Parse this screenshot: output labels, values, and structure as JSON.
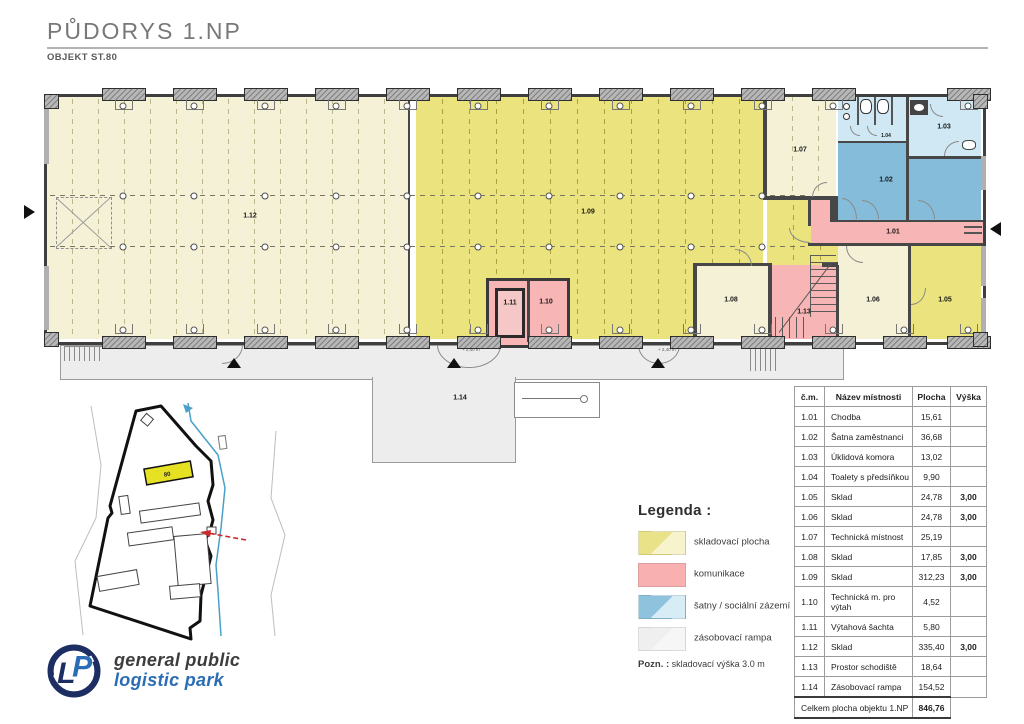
{
  "header": {
    "title": "PŮDORYS 1.NP",
    "subtitle": "OBJEKT ST.80"
  },
  "colors": {
    "storage_strong": "#ebe47e",
    "storage_pale": "#f4f1d6",
    "circulation": "#f8b5b5",
    "social": "#85bcd9",
    "social_light": "#cfe8f3",
    "ramp": "#ededed",
    "wall": "#474747",
    "site_highlight": "#e6e123",
    "stream": "#4aa0c8",
    "marker_red": "#cc2a2a",
    "logo_navy": "#1d2e63",
    "logo_blue": "#2a6db4"
  },
  "plan": {
    "labels": {
      "r101": "1.01",
      "r102": "1.02",
      "r103": "1.03",
      "r104": "1.04",
      "r105": "1.05",
      "r106": "1.06",
      "r107": "1.07",
      "r108": "1.08",
      "r109": "1.09",
      "r110": "1.10",
      "r111": "1.11",
      "r112": "1.12",
      "r113": "1.13",
      "r114": "1.14"
    },
    "dim_label": "+ 2,40 m"
  },
  "site_plan": {
    "building_label": "80"
  },
  "legend": {
    "title": "Legenda :",
    "items": [
      {
        "label": "skladovací plocha",
        "color_a": "#e9e288",
        "color_b": "#f6f3cd"
      },
      {
        "label": "komunikace",
        "color_a": "#f8b0b0",
        "color_b": "#f8b0b0"
      },
      {
        "label": "šatny / sociální zázemí",
        "color_a": "#8fc2dd",
        "color_b": "#d8ecf6"
      },
      {
        "label": "zásobovací rampa",
        "color_a": "#efefef",
        "color_b": "#f6f6f6"
      }
    ],
    "note_label": "Pozn. :",
    "note_text": "skladovací výška 3.0 m"
  },
  "room_table": {
    "headers": [
      "č.m.",
      "Název místnosti",
      "Plocha",
      "Výška"
    ],
    "rows": [
      [
        "1.01",
        "Chodba",
        "15,61",
        ""
      ],
      [
        "1.02",
        "Šatna zaměstnanci",
        "36,68",
        ""
      ],
      [
        "1.03",
        "Úklidová komora",
        "13,02",
        ""
      ],
      [
        "1.04",
        "Toalety s předsíňkou",
        "9,90",
        ""
      ],
      [
        "1.05",
        "Sklad",
        "24,78",
        "3,00"
      ],
      [
        "1.06",
        "Sklad",
        "24,78",
        "3,00"
      ],
      [
        "1.07",
        "Technická místnost",
        "25,19",
        ""
      ],
      [
        "1.08",
        "Sklad",
        "17,85",
        "3,00"
      ],
      [
        "1.09",
        "Sklad",
        "312,23",
        "3,00"
      ],
      [
        "1.10",
        "Technická m. pro výtah",
        "4,52",
        ""
      ],
      [
        "1.11",
        "Výtahová šachta",
        "5,80",
        ""
      ],
      [
        "1.12",
        "Sklad",
        "335,40",
        "3,00"
      ],
      [
        "1.13",
        "Prostor schodiště",
        "18,64",
        ""
      ],
      [
        "1.14",
        "Zásobovací rampa",
        "154,52",
        ""
      ]
    ],
    "total_label": "Celkem plocha objektu 1.NP",
    "total_value": "846,76"
  },
  "logo": {
    "monogram_l": "L",
    "monogram_p": "P",
    "line1": "general public",
    "line2": "logistic park"
  }
}
